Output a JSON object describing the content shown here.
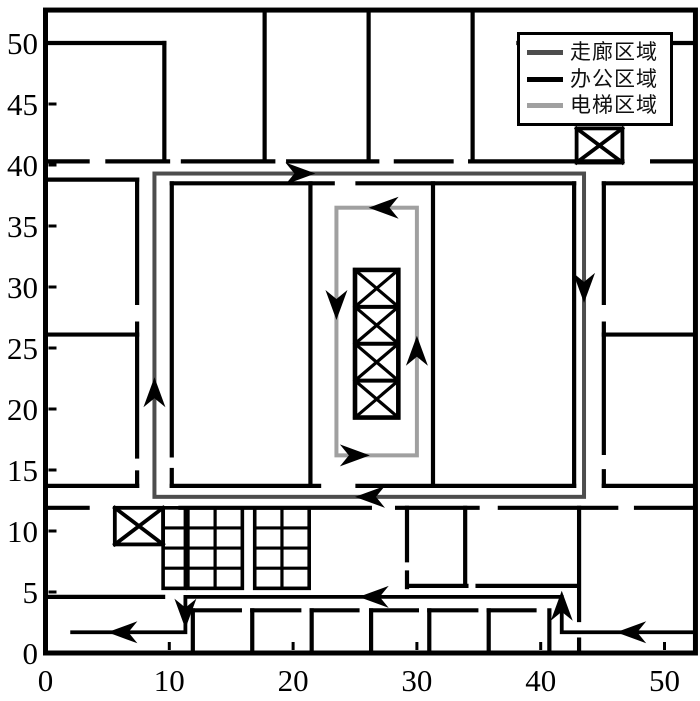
{
  "legend": {
    "entries": [
      {
        "label": "走廊区域",
        "color": "#4d4d4d"
      },
      {
        "label": "办公区域",
        "color": "#000000"
      },
      {
        "label": "电梯区域",
        "color": "#a0a0a0"
      }
    ]
  },
  "chart_data": {
    "type": "floor_plan_line_chart",
    "title": "",
    "axes": {
      "x": {
        "range": [
          0,
          52.5
        ],
        "ticks": [
          0,
          10,
          20,
          30,
          40,
          50
        ],
        "tick_labels": [
          "0",
          "10",
          "20",
          "30",
          "40",
          "50"
        ]
      },
      "y": {
        "range": [
          0,
          52.7
        ],
        "ticks": [
          0,
          5,
          10,
          15,
          20,
          25,
          30,
          35,
          40,
          45,
          50
        ],
        "tick_labels": [
          "0",
          "5",
          "10",
          "15",
          "20",
          "25",
          "30",
          "35",
          "40",
          "45",
          "50"
        ]
      },
      "grid": false
    },
    "wall_color": "#000000",
    "walls": [
      [
        0,
        50,
        9.6,
        50
      ],
      [
        9.6,
        40.3,
        9.6,
        50
      ],
      [
        17.7,
        40.3,
        17.7,
        52.7
      ],
      [
        26.1,
        40.3,
        26.1,
        52.7
      ],
      [
        34.5,
        40.3,
        34.5,
        52.7
      ],
      [
        38.2,
        50,
        52.5,
        50
      ],
      [
        0,
        40.3,
        3.4,
        40.3
      ],
      [
        5,
        40.3,
        9.9,
        40.3
      ],
      [
        11.1,
        40.3,
        18.4,
        40.3
      ],
      [
        19.6,
        40.3,
        26.8,
        40.3
      ],
      [
        28.3,
        40.3,
        32.8,
        40.3
      ],
      [
        34.3,
        40.3,
        46.6,
        40.3
      ],
      [
        49,
        40.3,
        52.5,
        40.3
      ],
      [
        0,
        38.8,
        7.4,
        38.8
      ],
      [
        7.4,
        28.7,
        7.4,
        38.8
      ],
      [
        7.4,
        16.1,
        7.4,
        27
      ],
      [
        7.4,
        13.7,
        7.4,
        14.8
      ],
      [
        0,
        26.1,
        7.4,
        26.1
      ],
      [
        0,
        13.7,
        7.4,
        13.7
      ],
      [
        10.2,
        38.5,
        23.2,
        38.5
      ],
      [
        25.2,
        38.5,
        42.7,
        38.5
      ],
      [
        10.2,
        16.2,
        10.2,
        38.5
      ],
      [
        10.2,
        13.7,
        10.2,
        15
      ],
      [
        42.7,
        13.7,
        42.7,
        38.5
      ],
      [
        21.4,
        13.7,
        21.4,
        38.5
      ],
      [
        31.3,
        13.7,
        31.3,
        38.5
      ],
      [
        10.2,
        13.7,
        22.1,
        13.7
      ],
      [
        25.2,
        13.7,
        42.7,
        13.7
      ],
      [
        45.1,
        28.7,
        45.1,
        38.5
      ],
      [
        45.1,
        16.4,
        45.1,
        27
      ],
      [
        45.1,
        13.7,
        45.1,
        14.9
      ],
      [
        45.1,
        38.5,
        52.5,
        38.5
      ],
      [
        45.1,
        26.1,
        52.5,
        26.1
      ],
      [
        45.1,
        13.7,
        52.5,
        13.7
      ],
      [
        0,
        11.9,
        3.4,
        11.9
      ],
      [
        10.9,
        11.9,
        26.2,
        11.9
      ],
      [
        28.4,
        11.9,
        34.9,
        11.9
      ],
      [
        36.7,
        11.9,
        46.1,
        11.9
      ],
      [
        47.7,
        11.9,
        52.5,
        11.9
      ],
      [
        29.2,
        7.6,
        29.2,
        11.9
      ],
      [
        29.2,
        5.4,
        29.2,
        6.6
      ],
      [
        33.9,
        5.7,
        33.9,
        11.9
      ],
      [
        29.3,
        5.5,
        34,
        5.5
      ],
      [
        34.9,
        5.5,
        42.9,
        5.5
      ],
      [
        43.1,
        2.7,
        43.1,
        11.9
      ],
      [
        43.1,
        0,
        43.1,
        1.1
      ],
      [
        0,
        4.6,
        9.5,
        4.6
      ],
      [
        11.9,
        0,
        11.9,
        3.5
      ],
      [
        16.7,
        0,
        16.7,
        3.5
      ],
      [
        21.5,
        0,
        21.5,
        3.5
      ],
      [
        26.3,
        0,
        26.3,
        3.5
      ],
      [
        31,
        0,
        31,
        3.5
      ],
      [
        35.8,
        0,
        35.8,
        3.5
      ],
      [
        40.7,
        0,
        40.7,
        3.5
      ],
      [
        11.9,
        3.5,
        15.7,
        3.5
      ],
      [
        16.7,
        3.5,
        20.5,
        3.5
      ],
      [
        21.5,
        3.5,
        25.2,
        3.5
      ],
      [
        26.3,
        3.5,
        30,
        3.5
      ],
      [
        31,
        3.5,
        34.8,
        3.5
      ],
      [
        35.8,
        3.5,
        39.5,
        3.5
      ]
    ],
    "stair_grids": [
      {
        "x": 9.5,
        "y": 5.3,
        "w": 1.8,
        "h": 6.6,
        "cols": 1,
        "rows": 4
      },
      {
        "x": 11.5,
        "y": 5.3,
        "w": 4.4,
        "h": 6.6,
        "cols": 2,
        "rows": 4
      },
      {
        "x": 16.9,
        "y": 5.3,
        "w": 4.4,
        "h": 6.6,
        "cols": 2,
        "rows": 4
      }
    ],
    "elevator_boxes": [
      {
        "x": 42.9,
        "y": 40.2,
        "w": 3.7,
        "h": 2.8
      },
      {
        "x": 5.6,
        "y": 8.9,
        "w": 3.9,
        "h": 3.0
      }
    ],
    "elevator_shaft": {
      "x": 25.0,
      "y": 19.3,
      "w": 3.5,
      "h": 12.1,
      "cells": 4
    },
    "region_loops": [
      {
        "name": "corridor-loop",
        "color": "#4d4d4d",
        "rect": [
          8.8,
          12.8,
          43.5,
          39.3
        ],
        "arrows": [
          {
            "x": 21.8,
            "y": 39.3,
            "dir": "right"
          },
          {
            "x": 43.5,
            "y": 28.7,
            "dir": "down"
          },
          {
            "x": 25.0,
            "y": 12.8,
            "dir": "left"
          },
          {
            "x": 8.8,
            "y": 22.6,
            "dir": "up"
          }
        ]
      },
      {
        "name": "elevator-loop",
        "color": "#a0a0a0",
        "rect": [
          23.5,
          16.2,
          30.0,
          36.5
        ],
        "arrows": [
          {
            "x": 26.1,
            "y": 36.5,
            "dir": "left"
          },
          {
            "x": 23.5,
            "y": 27.3,
            "dir": "down"
          },
          {
            "x": 30.0,
            "y": 26.0,
            "dir": "up"
          },
          {
            "x": 26.2,
            "y": 16.2,
            "dir": "right"
          }
        ]
      }
    ],
    "exit_route": {
      "color": "#000000",
      "points": [
        [
          52.5,
          1.7
        ],
        [
          41.7,
          1.7
        ],
        [
          41.7,
          4.6
        ],
        [
          11.3,
          4.6
        ],
        [
          11.3,
          1.7
        ],
        [
          2,
          1.7
        ]
      ],
      "arrows": [
        {
          "x": 46.1,
          "y": 1.7,
          "dir": "left"
        },
        {
          "x": 41.7,
          "y": 5.1,
          "dir": "up"
        },
        {
          "x": 25.3,
          "y": 4.6,
          "dir": "left"
        },
        {
          "x": 11.3,
          "y": 2.0,
          "dir": "down"
        },
        {
          "x": 5.0,
          "y": 1.7,
          "dir": "left"
        }
      ]
    }
  }
}
